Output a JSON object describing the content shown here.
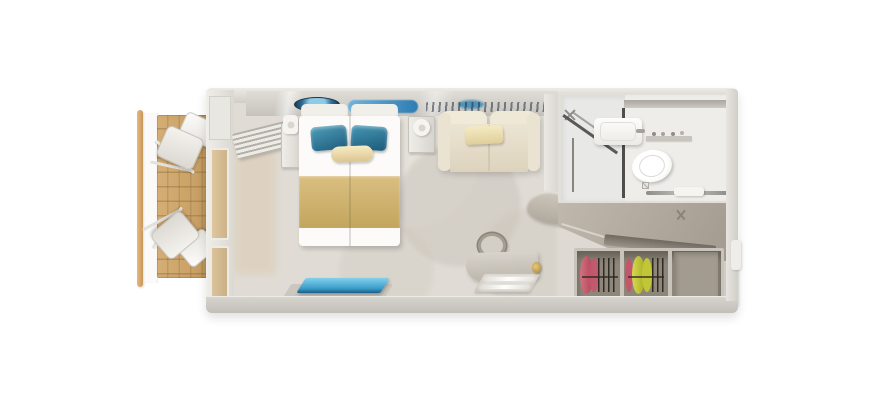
{
  "meta": {
    "type": "3d-floorplan-render",
    "subject": "Top-down 3D rendering of a cruise ship balcony stateroom",
    "background": "#ffffff"
  },
  "palette": {
    "outer_wall": "#d6d3cd",
    "inner_floor": "#e0dcd5",
    "balcony_wood": "#cda76e",
    "railing_wood": "#d9ab72",
    "bed_linen": "#fcfbfa",
    "pillow_teal": "#2f7f9f",
    "bed_runner_gold": "#cfb273",
    "sofa_cream": "#ece4d3",
    "accent_pillow_cream": "#f0e5bb",
    "rug_blue": "#3e9fd0",
    "desk_taupe": "#c9c3b9",
    "bathroom_white": "#eeede9",
    "shower_frame_grey": "#4f4e4a",
    "corridor_taupe": "#b3aca1",
    "wardrobe_interior": "#8e8779",
    "clothes_pink": "#c4566c",
    "clothes_yellow": "#c6ca39",
    "art_blue": "#4b9fd4"
  },
  "regions": {
    "balcony": {
      "label": "Balcony with wooden deck, railing and two deck chairs"
    },
    "bedroom": {
      "label": "Stateroom with double bed, sofa, desk and rug"
    },
    "bathroom": {
      "label": "Bathroom with shower, sink and toilet"
    },
    "entry": {
      "label": "Entry corridor"
    },
    "wardrobe": {
      "label": "Open wardrobe with hanging clothes"
    }
  },
  "objects": {
    "railing": {
      "label": "Balcony railing"
    },
    "deck": {
      "label": "Wooden balcony deck"
    },
    "deck_chair_top": {
      "label": "Deck chair"
    },
    "deck_chair_bottom": {
      "label": "Deck chair"
    },
    "sliding_door": {
      "label": "Balcony sliding glass door"
    },
    "curtain": {
      "label": "Curtain"
    },
    "artwork": {
      "label": "Wall artwork above bed"
    },
    "bed": {
      "label": "Double bed with teal pillows and gold runner"
    },
    "pillow_left": {
      "label": "Teal pillow"
    },
    "pillow_right": {
      "label": "Teal pillow"
    },
    "bolster": {
      "label": "Cream bolster pillow"
    },
    "runner": {
      "label": "Gold bed runner"
    },
    "nightstand_left": {
      "label": "Nightstand"
    },
    "nightstand_right": {
      "label": "Nightstand"
    },
    "lamp_left": {
      "label": "Wall lamp"
    },
    "lamp_right": {
      "label": "Wall lamp"
    },
    "sofa": {
      "label": "Cream sofa"
    },
    "sofa_pillow": {
      "label": "Sofa pillow"
    },
    "rug": {
      "label": "Blue rug"
    },
    "stool": {
      "label": "Desk chair"
    },
    "desk": {
      "label": "Desk / vanity"
    },
    "mirror_light": {
      "label": "Lit vanity panel"
    },
    "counter": {
      "label": "Corner counter"
    },
    "shower": {
      "label": "Shower enclosure"
    },
    "sink": {
      "label": "Sink"
    },
    "toilet": {
      "label": "Toilet"
    },
    "towel_rail": {
      "label": "Towel rail"
    },
    "sprinkler": {
      "label": "Ceiling sprinkler"
    },
    "luggage_shelf": {
      "label": "Angled shelf"
    },
    "clothes_pink": {
      "label": "Hanging clothes (pink)"
    },
    "clothes_yellow": {
      "label": "Hanging clothes (yellow)"
    },
    "wardrobe_empty": {
      "label": "Empty wardrobe section"
    },
    "cabin_door": {
      "label": "Cabin entry door"
    }
  }
}
